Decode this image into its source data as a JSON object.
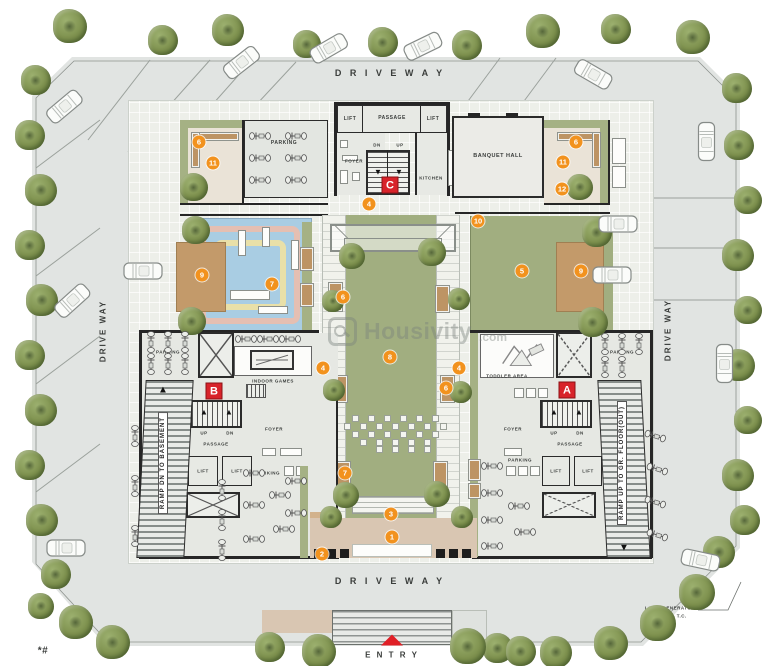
{
  "watermark": {
    "brand": "Housivity",
    "tld": ".com"
  },
  "driveways": {
    "top": "D R I V E   W A Y",
    "bottom": "D R I V E   W A Y",
    "left": "DRIVE WAY",
    "right": "DRIVE WAY"
  },
  "entry_label": "E N T R Y",
  "badges": {
    "a": "A",
    "b": "B",
    "c": "C"
  },
  "rooms": {
    "lift": "LIFT",
    "passage": "PASSAGE",
    "foyer": "FOYER",
    "kitchen": "KITCHEN",
    "banquet_hall": "BANQUET HALL",
    "parking": "PARKING",
    "indoor_games": "INDOOR GAMES",
    "toddler_area": "TODDLER AREA"
  },
  "stairs": {
    "up": "UP",
    "dn": "DN"
  },
  "ramps": {
    "basement": "RAMP DN TO BASEMENT",
    "ground": "RAMP UP TO GR. FLOOR(OUT)"
  },
  "notes": {
    "generator": "LOW - GENERATOR",
    "upper": "UPPER - T.C.",
    "footnote": "*#"
  },
  "markers": [
    {
      "n": "1",
      "x": 392,
      "y": 537
    },
    {
      "n": "2",
      "x": 322,
      "y": 554
    },
    {
      "n": "3",
      "x": 391,
      "y": 514
    },
    {
      "n": "4",
      "x": 369,
      "y": 204
    },
    {
      "n": "4",
      "x": 323,
      "y": 368
    },
    {
      "n": "4",
      "x": 459,
      "y": 368
    },
    {
      "n": "5",
      "x": 522,
      "y": 271
    },
    {
      "n": "6",
      "x": 199,
      "y": 142
    },
    {
      "n": "6",
      "x": 576,
      "y": 142
    },
    {
      "n": "6",
      "x": 343,
      "y": 297
    },
    {
      "n": "6",
      "x": 446,
      "y": 388
    },
    {
      "n": "7",
      "x": 272,
      "y": 284
    },
    {
      "n": "7",
      "x": 345,
      "y": 473
    },
    {
      "n": "8",
      "x": 390,
      "y": 357
    },
    {
      "n": "9",
      "x": 202,
      "y": 275
    },
    {
      "n": "9",
      "x": 581,
      "y": 271
    },
    {
      "n": "10",
      "x": 478,
      "y": 221
    },
    {
      "n": "11",
      "x": 213,
      "y": 163
    },
    {
      "n": "11",
      "x": 563,
      "y": 162
    },
    {
      "n": "12",
      "x": 562,
      "y": 189
    }
  ],
  "colors": {
    "marker": "#f2921e",
    "badge_red": "#d8232a",
    "lawn": "#a1ae80",
    "water": "#a9cde3",
    "deck": "#c39a6a",
    "plaza": "#d9c6b2",
    "entry_arrow": "#e01f26"
  }
}
